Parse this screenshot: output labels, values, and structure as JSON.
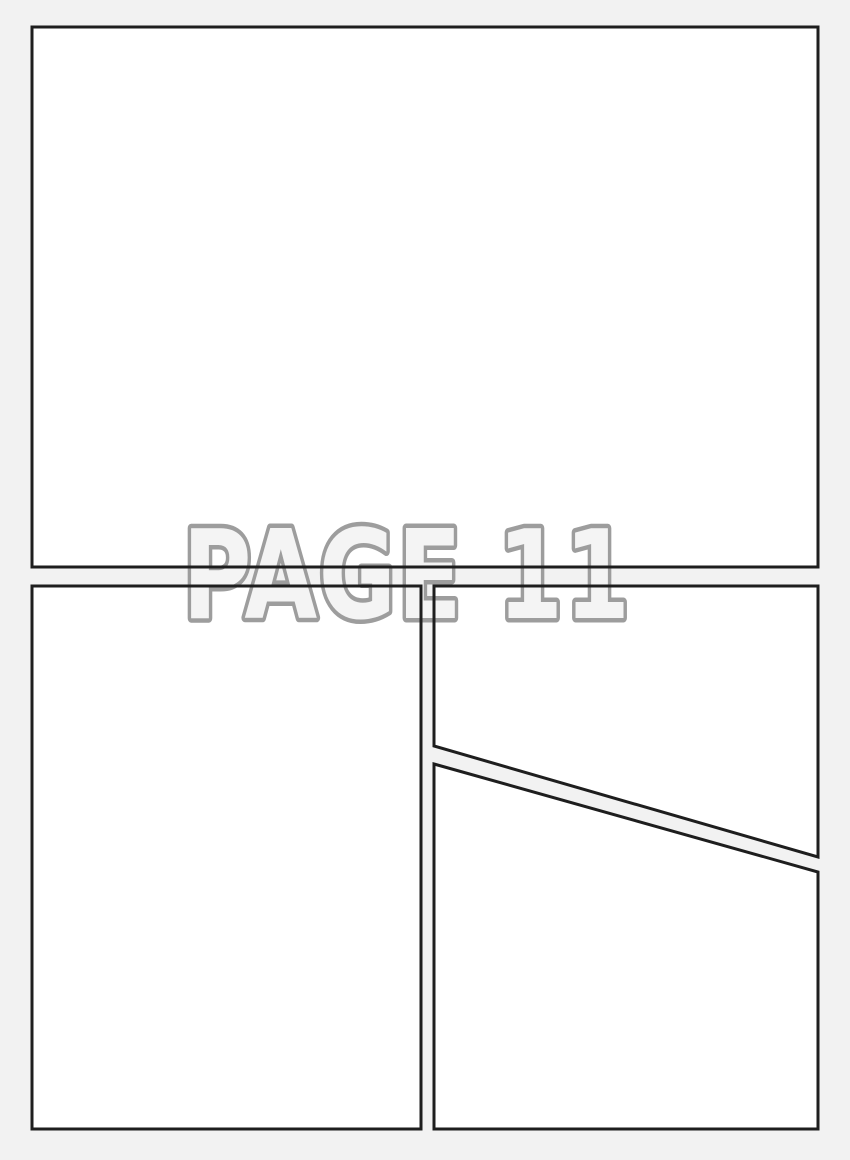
{
  "page": {
    "label_text": "PAGE 11"
  },
  "colors": {
    "page_background": "#f2f2f2",
    "panel_fill": "#ffffff",
    "panel_border": "#1e1e1e",
    "label_fill": "#f4f4f4",
    "label_outline": "#9d9d9d"
  }
}
